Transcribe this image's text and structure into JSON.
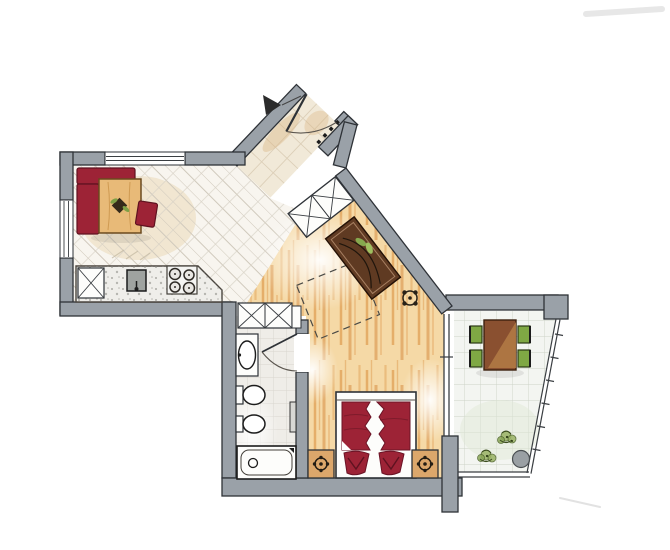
{
  "meta": {
    "title": "apartment-floor-plan",
    "style": "hand-drawn-marker-sketch"
  },
  "palette": {
    "paper": "#ffffff",
    "wall_fill": "#9aa1a8",
    "wall_outline": "#2e3237",
    "tile_floor": "#f8f5ef",
    "tile_line": "#d0c9bc",
    "hall_floor": "#f1e9d8",
    "hall_shade": "#d9b482",
    "wood_base": "#f5d9a6",
    "wood_grain": "#de9b4f",
    "bath_floor": "#efede8",
    "balcony_floor": "#f3f5f1",
    "fixture_white": "#fdfdfb",
    "accent_red": "#9d2336",
    "accent_red_outline": "#5f1220",
    "table_wood": "#e8ba78",
    "sideboard_brown": "#5f3a22",
    "balcony_table": "#8a5030",
    "balcony_table_light": "#b07945",
    "chair_green": "#7fa844",
    "plant_green": "#9ab365",
    "nightstand_tan": "#dca76b",
    "counter_gray": "#efeeea",
    "sink_gray": "#9fa3a0",
    "pot_gray": "#9aa0a4",
    "marker_dark": "#1c1c1c"
  },
  "rooms": [
    {
      "id": "entrance-hall",
      "features": [
        "entrance-door",
        "door-swing",
        "entry-arrow",
        "coat-hooks",
        "hall-wardrobe",
        "tiled-floor"
      ]
    },
    {
      "id": "dining-kitchen",
      "features": [
        "window-top",
        "window-left",
        "corner-bench",
        "dining-table",
        "dining-chair",
        "kitchen-counter",
        "tall-cabinet",
        "sink",
        "stove"
      ]
    },
    {
      "id": "living-area",
      "features": [
        "wood-floor",
        "sideboard",
        "houseplant",
        "rug-outline",
        "floor-plant"
      ]
    },
    {
      "id": "sleeping-area",
      "features": [
        "double-bed",
        "duvets",
        "pillows",
        "nightstand-left",
        "nightstand-right",
        "table-lamps"
      ]
    },
    {
      "id": "bathroom",
      "features": [
        "closet",
        "washbasin",
        "toilet",
        "bidet",
        "bathtub",
        "door",
        "radiator"
      ]
    },
    {
      "id": "balcony",
      "features": [
        "table",
        "chairs",
        "potted-plants",
        "planter-pot",
        "railing",
        "glass-wall"
      ]
    }
  ]
}
